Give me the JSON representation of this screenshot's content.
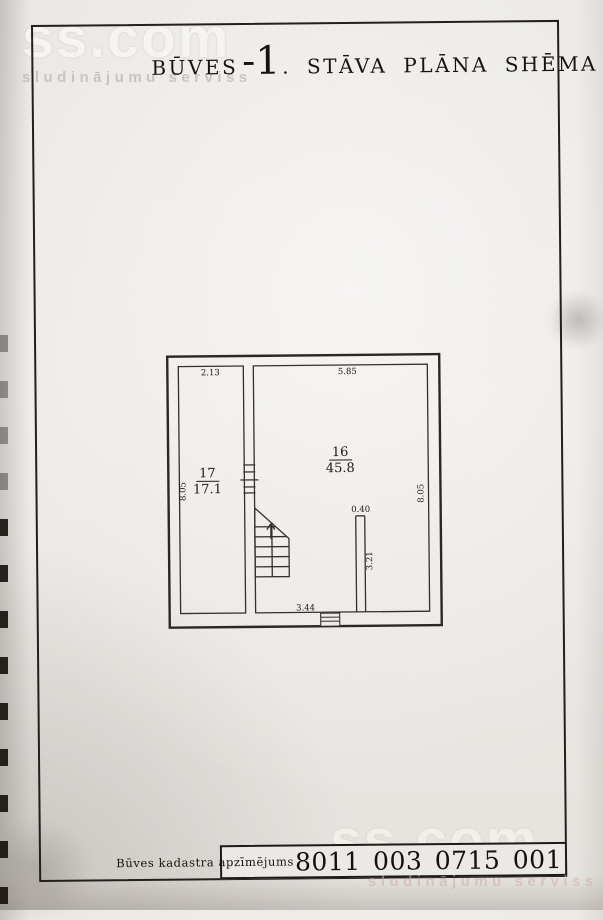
{
  "watermark": {
    "brand": "ss.com",
    "tagline": "sludinājumu serviss"
  },
  "title": {
    "prefix": "BŪVES",
    "floor": "-1",
    "suffix": ". STĀVA PLĀNA SHĒMA"
  },
  "floor_plan": {
    "rooms": [
      {
        "number": "17",
        "area": "17.1"
      },
      {
        "number": "16",
        "area": "45.8"
      }
    ],
    "dims": {
      "room17_width": "2.13",
      "room17_height": "8.05",
      "room16_width": "5.85",
      "room16_height": "8.05",
      "niche_width": "0.40",
      "niche_height": "3.21",
      "entry_span": "3.44"
    }
  },
  "footer": {
    "label": "Būves kadastra apzīmējums",
    "value": "8011 003 0715 001"
  }
}
